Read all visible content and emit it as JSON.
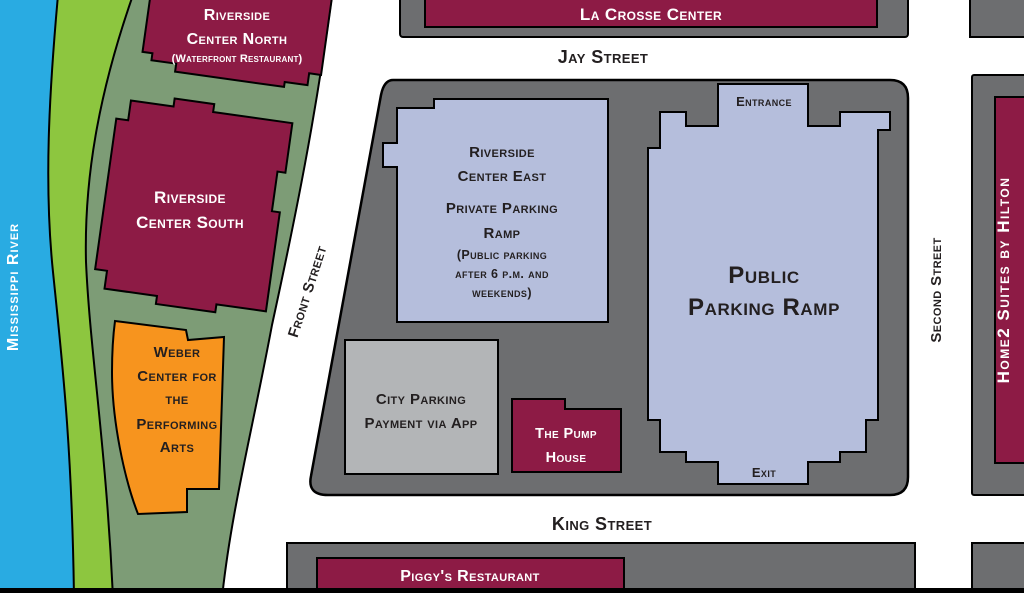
{
  "streets": {
    "jay": "Jay Street",
    "king": "King Street",
    "front": "Front Street",
    "second": "Second Street"
  },
  "river": {
    "label": "Mississippi River"
  },
  "buildings": {
    "la_crosse_center": {
      "label": "La Crosse Center"
    },
    "riverside_center_north": {
      "lines": [
        "Riverside",
        "Center North",
        "(Waterfront Restaurant)"
      ]
    },
    "riverside_center_south": {
      "lines": [
        "Riverside",
        "Center South"
      ]
    },
    "weber_center": {
      "lines": [
        "Weber",
        "Center for",
        "the",
        "Performing",
        "Arts"
      ]
    },
    "riverside_center_east": {
      "lines": [
        "Riverside",
        "Center East",
        "Private Parking",
        "Ramp",
        "(Public parking",
        "after 6 p.m. and",
        "weekends)"
      ]
    },
    "public_parking_ramp": {
      "lines": [
        "Public",
        "Parking Ramp"
      ],
      "entrance_label": "Entrance",
      "exit_label": "Exit"
    },
    "city_parking": {
      "lines": [
        "City Parking",
        "Payment via App"
      ]
    },
    "pump_house": {
      "lines": [
        "The Pump",
        "House"
      ]
    },
    "piggys_restaurant": {
      "label": "Piggy's Restaurant"
    },
    "home2_suites": {
      "label": "Home2 Suites by Hilton"
    }
  },
  "colors": {
    "river_blue": "#29ABE2",
    "park_lime": "#8DC63F",
    "park_sage": "#7D9C76",
    "building_maroon": "#8D1B45",
    "building_orange": "#F7941E",
    "parking_periwinkle": "#B5BEDC",
    "block_gray": "#6D6E70",
    "building_light_gray": "#B3B5B7",
    "outline_black": "#000000",
    "street_text": "#231F20"
  }
}
